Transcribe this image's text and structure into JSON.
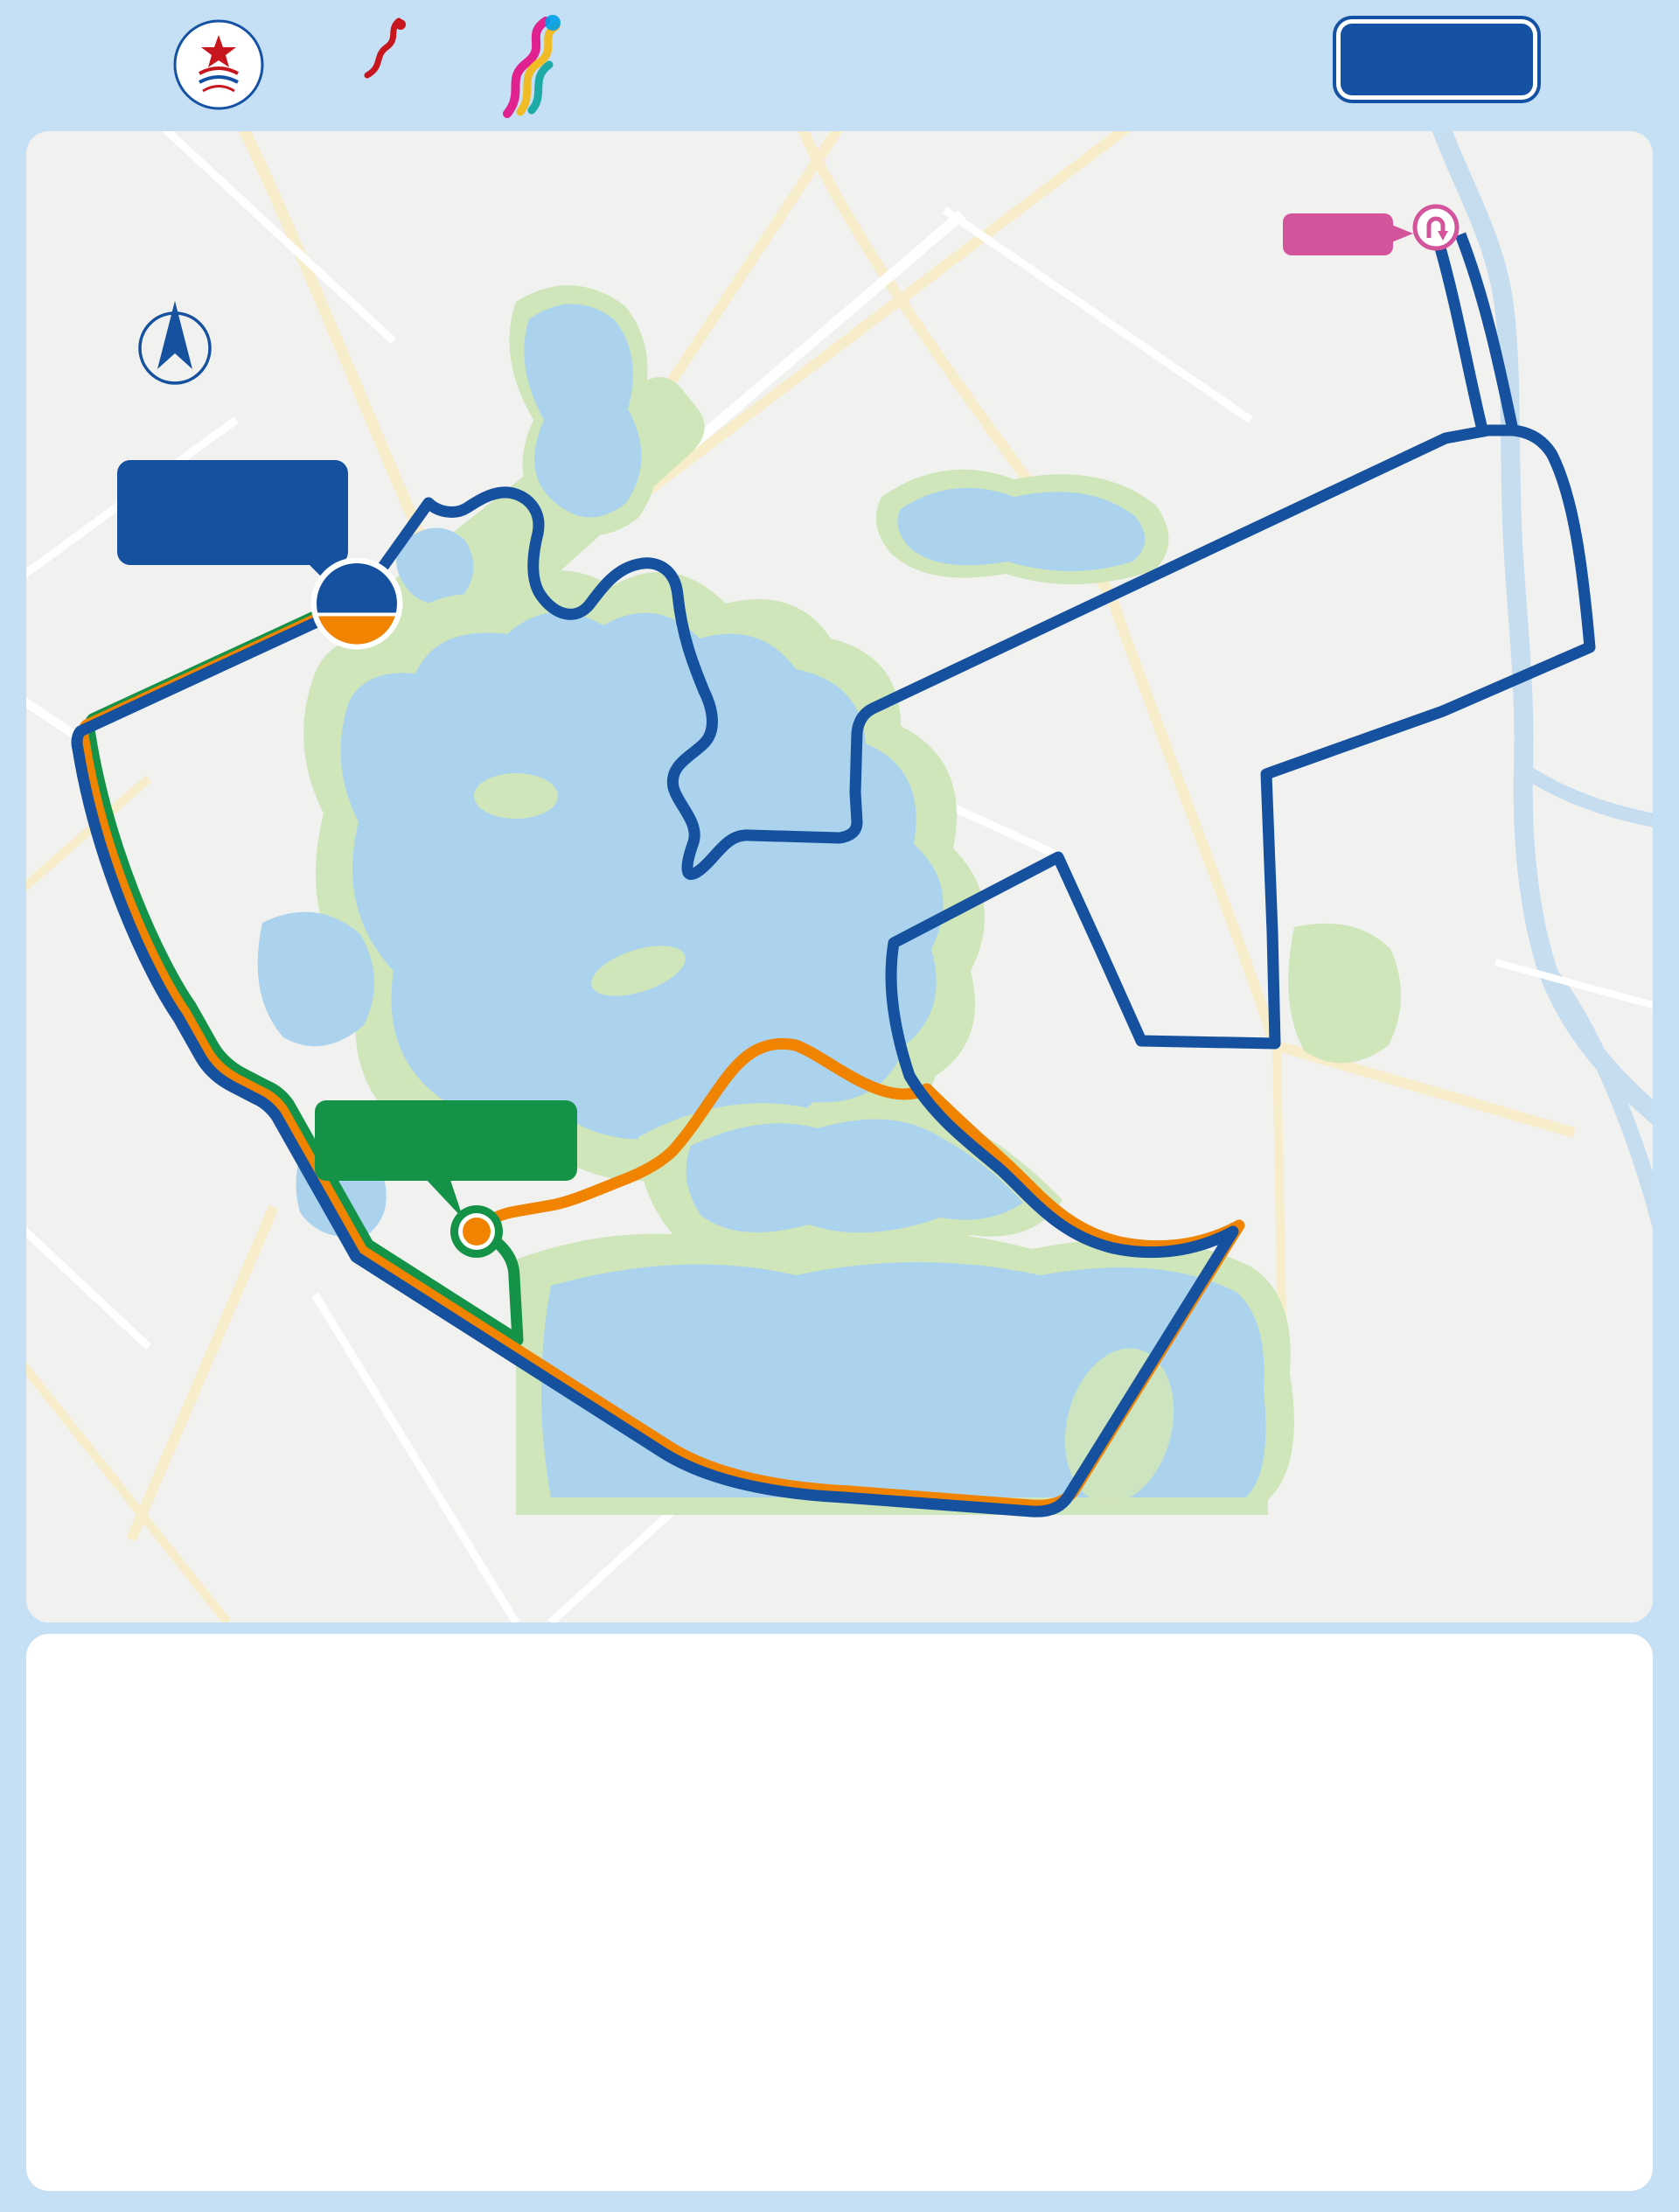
{
  "header": {
    "year": "2024",
    "title_zh": "黄冈半程马拉松",
    "subtitle_en": "HUANGGANG HALF MARATHON",
    "badge": "路线图",
    "caa_name": "中国田径协会",
    "china_marathon": {
      "line1": "CHINA",
      "line2": "MARATHON",
      "line3": "中国马拉松"
    }
  },
  "map": {
    "north_label": "北",
    "start_badge": {
      "line1": "START",
      "line2": "FINISH"
    },
    "start_callout": {
      "line1": "赛事起点 / 半马终点",
      "line2": "遗爱清风广场"
    },
    "theater_callout": {
      "line1": "健康跑/欢乐跑/亲子跑终点",
      "line2": "黄梅戏大剧院"
    },
    "turnaround_label": "折返点",
    "route_colors": {
      "half": "#15519e",
      "health": "#f08300",
      "fun": "#149247"
    },
    "km_markers": [
      {
        "n": "1",
        "x": 58,
        "y": 705,
        "s": "w"
      },
      {
        "n": "2",
        "x": 173,
        "y": 1016,
        "s": "w"
      },
      {
        "n": "2.5",
        "x": 272,
        "y": 1110,
        "s": "y"
      },
      {
        "n": "3",
        "x": 377,
        "y": 1287,
        "s": "w"
      },
      {
        "n": "4",
        "x": 723,
        "y": 1508,
        "s": "w"
      },
      {
        "n": "5",
        "x": 1040,
        "y": 1577,
        "s": "y"
      },
      {
        "n": "6",
        "x": 1165,
        "y": 1585,
        "s": "w"
      },
      {
        "n": "7",
        "x": 1380,
        "y": 1256,
        "s": "w"
      },
      {
        "n": "7.5",
        "x": 1243,
        "y": 1275,
        "s": "y"
      },
      {
        "n": "8",
        "x": 1115,
        "y": 1188,
        "s": "w"
      },
      {
        "n": "9",
        "x": 992,
        "y": 928,
        "s": "w"
      },
      {
        "n": "10",
        "x": 1227,
        "y": 933,
        "s": "y"
      },
      {
        "n": "11",
        "x": 1425,
        "y": 916,
        "s": "w"
      },
      {
        "n": "12",
        "x": 1620,
        "y": 663,
        "s": "w"
      },
      {
        "n": "12.5",
        "x": 1770,
        "y": 593,
        "s": "y"
      },
      {
        "n": "13",
        "x": 1763,
        "y": 450,
        "s": "w"
      },
      {
        "n": "14",
        "x": 1598,
        "y": 145,
        "s": "w"
      },
      {
        "n": "15",
        "x": 1623,
        "y": 349,
        "s": "y"
      },
      {
        "n": "16",
        "x": 1209,
        "y": 544,
        "s": "w"
      },
      {
        "n": "17",
        "x": 948,
        "y": 756,
        "s": "w"
      },
      {
        "n": "17.5",
        "x": 827,
        "y": 803,
        "s": "y"
      },
      {
        "n": "18",
        "x": 763,
        "y": 813,
        "s": "w"
      },
      {
        "n": "19",
        "x": 745,
        "y": 530,
        "s": "w"
      },
      {
        "n": "20",
        "x": 588,
        "y": 530,
        "s": "y"
      },
      {
        "n": "9",
        "x": 836,
        "y": 1050,
        "s": "o"
      },
      {
        "n": "10",
        "x": 558,
        "y": 1235,
        "s": "o"
      }
    ],
    "km_unit": "km",
    "road_labels": [
      {
        "t": "赤壁大道",
        "x": 412,
        "y": 398,
        "rot": -38,
        "size": 34
      },
      {
        "t": "赤壁大道",
        "x": 88,
        "y": 295,
        "vert": true,
        "rot": -14,
        "size": 32
      },
      {
        "t": "黄州大道",
        "x": 97,
        "y": 858,
        "vert": true,
        "rot": -16,
        "size": 32
      },
      {
        "t": "黄州大道",
        "x": 800,
        "y": 1655,
        "rot": 13,
        "size": 37
      },
      {
        "t": "环湖路",
        "x": 616,
        "y": 512,
        "vert": true,
        "rot": 0,
        "size": 31
      },
      {
        "t": "文峰路",
        "x": 988,
        "y": 668,
        "vert": true,
        "rot": 0,
        "size": 31
      },
      {
        "t": "新港一路",
        "x": 1318,
        "y": 468,
        "rot": -23,
        "size": 32
      },
      {
        "t": "新港二路",
        "x": 1068,
        "y": 852,
        "rot": -22,
        "size": 32
      },
      {
        "t": "新港二路",
        "x": 1618,
        "y": 625,
        "rot": -22,
        "size": 32
      },
      {
        "t": "新港三路",
        "x": 1428,
        "y": 1055,
        "rot": -12,
        "size": 32
      },
      {
        "t": "新港大道",
        "x": 1203,
        "y": 938,
        "vert": true,
        "rot": -14,
        "size": 32
      },
      {
        "t": "新港大道",
        "x": 1522,
        "y": 1408,
        "vert": true,
        "rot": 0,
        "size": 32
      },
      {
        "t": "明珠大道",
        "x": 1500,
        "y": 803,
        "vert": true,
        "rot": -8,
        "size": 32
      },
      {
        "t": "长河大道",
        "x": 1792,
        "y": 326,
        "vert": true,
        "rot": -10,
        "size": 32
      },
      {
        "t": "湖心路",
        "x": 702,
        "y": 1245,
        "rot": -14,
        "size": 31
      }
    ],
    "poi_labels": [
      {
        "t": "遗爱湖公园",
        "x": 670,
        "y": 886,
        "size": 40
      },
      {
        "t": "东湖",
        "x": 1010,
        "y": 1433,
        "size": 42
      },
      {
        "t": "青砖湖",
        "x": 116,
        "y": 1072,
        "size": 36
      },
      {
        "t": "黄梅戏\n大剧院",
        "x": 601,
        "y": 1300,
        "size": 36
      },
      {
        "t": "黄冈市博物馆",
        "x": 1185,
        "y": 208,
        "size": 34
      },
      {
        "t": "黄冈师范学院",
        "x": 1622,
        "y": 996,
        "size": 34
      },
      {
        "t": "湖北省黄冈中学",
        "x": 1718,
        "y": 1106,
        "size": 34
      }
    ],
    "gray_pois": [
      {
        "icon": "star",
        "t": "黄州区政府",
        "x": 68,
        "y": 1352
      },
      {
        "icon": "bus",
        "t": "黄州客运站",
        "x": 112,
        "y": 1452
      }
    ],
    "poi_icons": [
      {
        "icon": "museum",
        "x": 1163,
        "y": 162
      },
      {
        "icon": "book",
        "x": 1475,
        "y": 988
      },
      {
        "icon": "book",
        "x": 1580,
        "y": 1100
      },
      {
        "icon": "tree",
        "x": 652,
        "y": 915
      }
    ],
    "facility_groups": [
      {
        "x": 112,
        "y": 318,
        "rows": [
          [
            "medical",
            "ambulance",
            "water",
            "drink",
            "banana",
            "wc",
            "timer"
          ]
        ]
      },
      {
        "x": 475,
        "y": 556,
        "rows": [
          [
            "medical",
            "ambulance",
            "water",
            "drink"
          ],
          [
            "wc",
            "timer"
          ]
        ]
      },
      {
        "x": 855,
        "y": 663,
        "rows": [
          [
            "medical",
            "ambulance",
            "water"
          ],
          [
            "banana",
            "sponge",
            "timer"
          ]
        ]
      },
      {
        "x": 1222,
        "y": 814,
        "rows": [
          [
            "medical",
            "ambulance",
            "water"
          ],
          [
            "drink",
            "wc",
            "timer"
          ]
        ]
      },
      {
        "x": 1700,
        "y": 634,
        "rows": [
          [
            "medical",
            "ambulance",
            "water"
          ],
          [
            "banana",
            "sponge",
            "wc"
          ]
        ]
      },
      {
        "x": 1475,
        "y": 244,
        "rows": [
          [
            "medical",
            "ambulance",
            "water",
            "drink"
          ],
          [
            "banana",
            "wc",
            "timer"
          ]
        ]
      },
      {
        "x": 1646,
        "y": 86,
        "rows": [
          [
            "timer"
          ]
        ]
      },
      {
        "x": 203,
        "y": 1151,
        "rows": [
          [
            "medical",
            "ambulance"
          ]
        ]
      },
      {
        "x": 406,
        "y": 1063,
        "rows": [
          [
            "medical",
            "ambulance",
            "water",
            "wc"
          ]
        ]
      },
      {
        "x": 1140,
        "y": 1276,
        "rows": [
          [
            "medical",
            "ambulance"
          ],
          [
            "sponge",
            "water",
            "wc"
          ]
        ]
      },
      {
        "x": 969,
        "y": 1489,
        "rows": [
          [
            "medical",
            "ambulance",
            "water"
          ],
          [
            "drink",
            "wc",
            "timer"
          ]
        ]
      }
    ]
  },
  "footer": {
    "route_legend": [
      {
        "label": "半马路线",
        "color": "#15519e",
        "x": 35
      },
      {
        "label": "健康跑路线",
        "color": "#f08300",
        "x": 445
      },
      {
        "label": "欢乐跑/亲子跑路线",
        "color": "#149247",
        "x": 890
      }
    ],
    "desc_heading": "线路描述",
    "descriptions": [
      {
        "lead": "半程马拉松（21.0975km）：",
        "cls": "c-blue",
        "body": "遗爱清风广场（起点）－赤壁大道－黄州大道－黄梅戏大剧院－黄州大道－新港大道－遗爱湖湿地展览馆－松风亭－十一孔桥－五孔桥－凌湖桥－望湖路－新港二路－新港大道－新港三路－明珠大道－新港二路－长河大道－长河公园（折返）－长河大道－新港一路－文峰路－遗爱湖公园东门－环湖路－赤壁大道－遗爱清风广场（终点）"
      },
      {
        "lead": "健康跑(10公里)：",
        "cls": "c-orange",
        "body": "遗爱清风广场（起点）－赤壁大道－黄州大道－黄梅戏大剧院－黄州大道－新港大道－遗爱湖湿地展览馆－松风亭－十一孔桥－五孔桥－凌湖桥－望湖路－湖心路－黄梅戏大剧院（终点）"
      },
      {
        "lead": "欢乐跑/亲子跑(3公里)：",
        "cls": "c-green",
        "body": "遗爱清风广场（起点）－赤壁大道－黄州大道－黄梅戏大剧院（终点）"
      }
    ],
    "legend_heading": "图例",
    "legend_icons": [
      {
        "icon": "wc",
        "label": "厕所"
      },
      {
        "icon": "water",
        "label": "饮水站"
      },
      {
        "icon": "sponge",
        "label": "海绵降温站"
      },
      {
        "icon": "drink",
        "label": "饮料站"
      },
      {
        "icon": "banana",
        "label": "补给站"
      },
      {
        "icon": "timer",
        "label": "计时点"
      },
      {
        "icon": "spray",
        "label": "喷淋点"
      },
      {
        "icon": "medical",
        "label": "医疗站"
      },
      {
        "icon": "ambulance",
        "label": "救护车"
      }
    ]
  },
  "chart_data": {
    "type": "area",
    "title": "海拔: m",
    "xlabel": "距离: km",
    "x": [
      0,
      1,
      2,
      3,
      4,
      5,
      6,
      7,
      8,
      9,
      10,
      11,
      12,
      13,
      14,
      15,
      16,
      17,
      18,
      19,
      20,
      21
    ],
    "values": [
      26,
      37,
      27,
      24.5,
      24.5,
      16.5,
      16.5,
      21.5,
      24.5,
      19,
      26,
      21.5,
      25,
      26,
      31,
      37.5,
      27,
      24.5,
      23,
      21.5,
      20,
      20
    ],
    "yticks": [
      10,
      20,
      30,
      40
    ],
    "ylim": [
      0,
      48
    ],
    "grid": true,
    "legend_position": "none"
  }
}
